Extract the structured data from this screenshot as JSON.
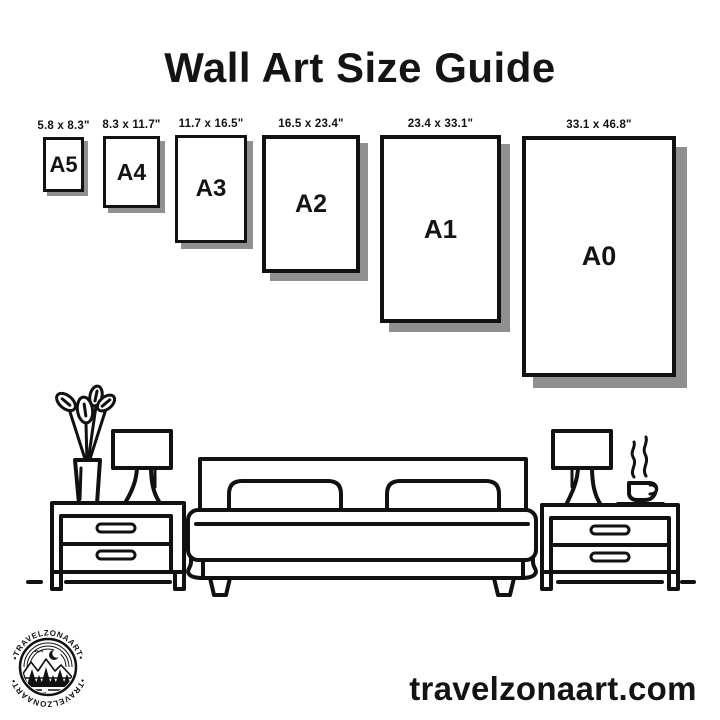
{
  "title": "Wall Art Size Guide",
  "sizes": [
    {
      "name": "A5",
      "dimensions": "5.8 x 8.3\""
    },
    {
      "name": "A4",
      "dimensions": "8.3 x 11.7\""
    },
    {
      "name": "A3",
      "dimensions": "11.7 x 16.5\""
    },
    {
      "name": "A2",
      "dimensions": "16.5 x 23.4\""
    },
    {
      "name": "A1",
      "dimensions": "23.4 x 33.1\""
    },
    {
      "name": "A0",
      "dimensions": "33.1 x 46.8\""
    }
  ],
  "logo": {
    "arc_text_top": "•TRAVELZONAART•",
    "arc_text_bottom": "•TRAVELZONAART•"
  },
  "footer": {
    "website": "travelzonaart.com"
  },
  "colors": {
    "ink": "#111111",
    "shadow": "#8f8f8f",
    "background": "#ffffff"
  },
  "scene_objects": [
    "plant-vase",
    "table-lamp",
    "nightstand",
    "double-bed",
    "nightstand",
    "table-lamp",
    "coffee-cup",
    "floor-line"
  ]
}
